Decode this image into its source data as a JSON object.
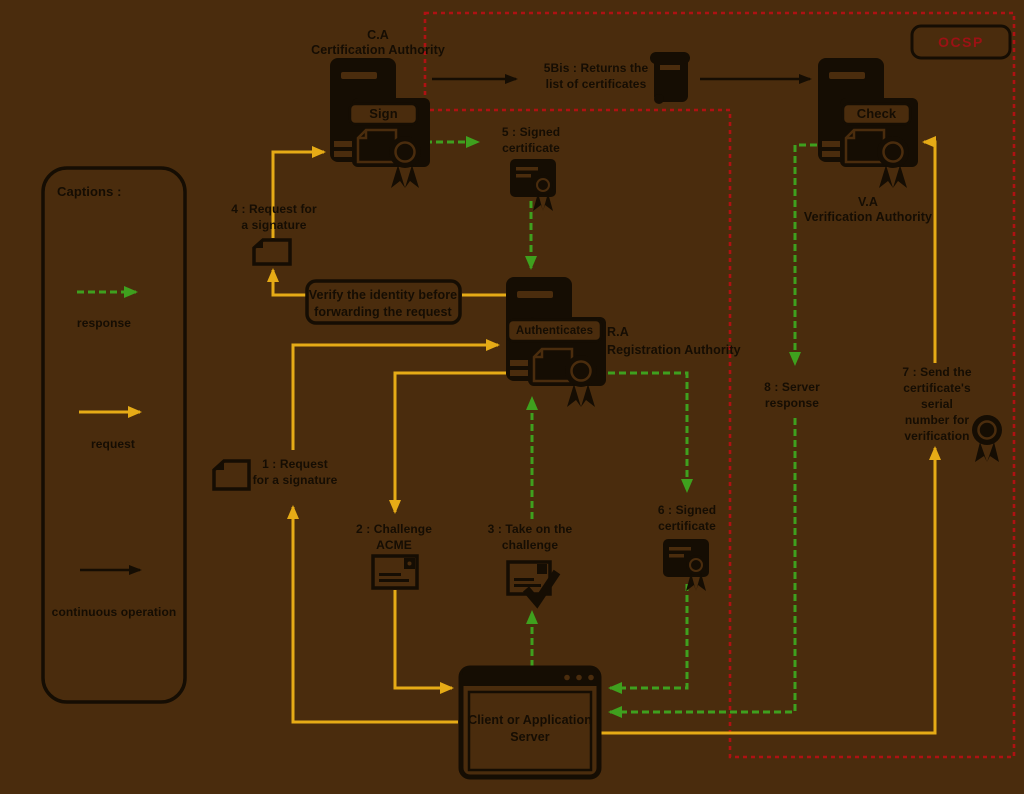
{
  "colors": {
    "background": "#4A2C0D",
    "ink": "#150D03",
    "response_green": "#3FA01E",
    "request_yellow": "#E6AB16",
    "ocsp_red": "#AF1113",
    "ocsp_text_red": "#9C1114"
  },
  "captions": {
    "title": "Captions :",
    "items": [
      {
        "label": "response",
        "type": "green-dashed-arrow"
      },
      {
        "label": "request",
        "type": "yellow-solid-arrow"
      },
      {
        "label": "continuous operation",
        "type": "black-solid-arrow"
      }
    ]
  },
  "nodes": {
    "ca": {
      "title": "C.A\nCertification Authority",
      "action": "Sign"
    },
    "ra": {
      "title": "R.A\nRegistration Authority",
      "action": "Authenticates"
    },
    "va": {
      "title": "V.A\nVerification Authority",
      "action": "Check"
    },
    "client": {
      "title": "Client or Application\nServer"
    },
    "ocsp": {
      "label": "OCSP"
    }
  },
  "steps": {
    "s1": "1 : Request\nfor a signature",
    "s2": "2 : Challenge\nACME",
    "s3": "3 : Take on the\nchallenge",
    "s4": "4 : Request for\na signature",
    "s5": "5 : Signed\ncertificate",
    "s5bis": "5Bis : Returns the\nlist of certificates",
    "s6": "6 : Signed\ncertificate",
    "s7": "7 :  Send the\ncertificate's serial\nnumber for\nverification",
    "s8": "8 : Server\nresponse",
    "verify_note": "Verify the identity before\nforwarding the request"
  },
  "icons": {
    "server-icon": "tower computer with attached certificate panel",
    "certificate-seal-icon": "dark card with award seal and ribbons",
    "rosette-icon": "award seal ring with ribbons",
    "document-icon": "page with folded corner",
    "envelope-icon": "email envelope with @ badge",
    "envelope-check-icon": "envelope with check mark",
    "scroll-icon": "rolled certificate list scroll",
    "browser-window-icon": "application window with title bar dots"
  }
}
